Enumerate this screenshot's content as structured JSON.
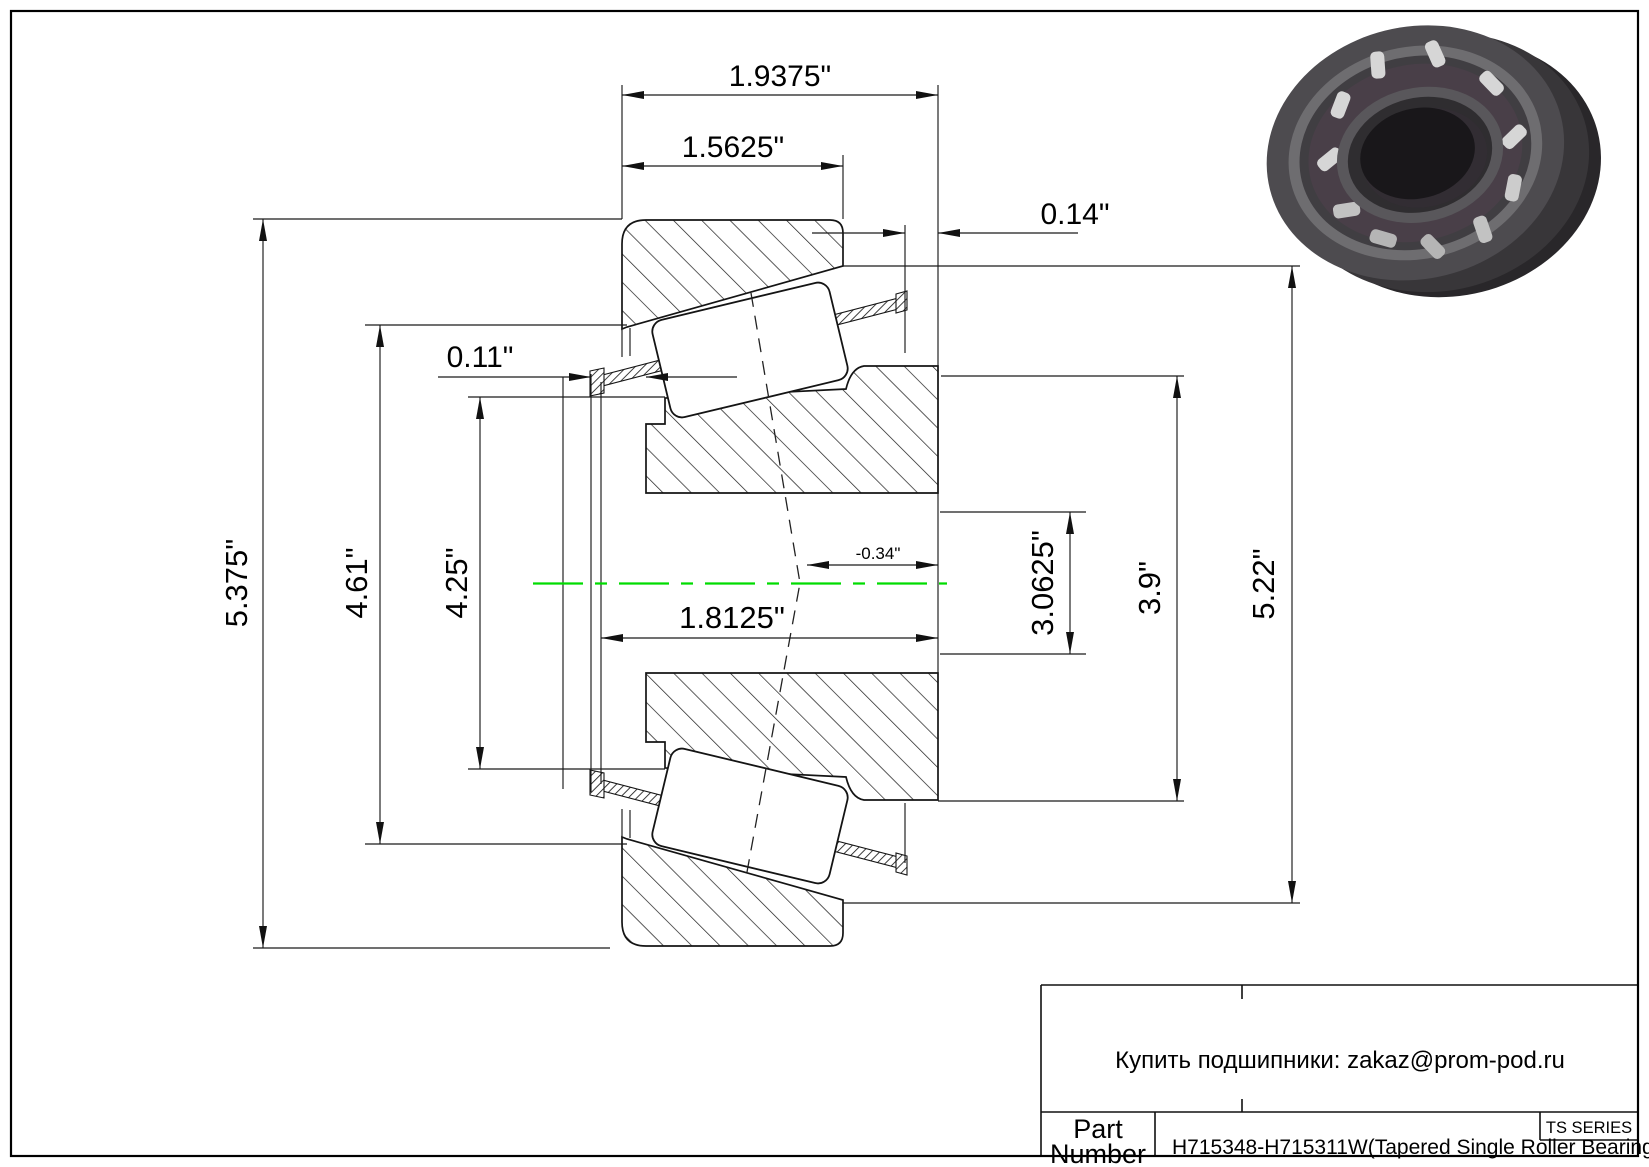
{
  "drawing": {
    "type": "Tapered roller bearing cross-section drawing",
    "dimensions": {
      "overall_width": "1.9375\"",
      "cup_width": "1.5625\"",
      "back_offset": "0.14\"",
      "front_offset": "0.11\"",
      "outer_diameter": "5.375\"",
      "dia_4_61": "4.61\"",
      "dia_4_25": "4.25\"",
      "cone_width": "1.8125\"",
      "center_offset": "-0.34\"",
      "bore_diameter": "3.0625\"",
      "dia_3_9": "3.9\"",
      "dia_5_22": "5.22\""
    },
    "colors": {
      "centerline_green": "#00DC00",
      "line_black": "#141414",
      "background": "#ffffff"
    }
  },
  "title_block": {
    "contact": "Купить подшипники: zakaz@prom-pod.ru",
    "series": "TS SERIES",
    "part_label_line1": "Part",
    "part_label_line2": "Number",
    "part_value": "H715348-H715311W(Tapered Single Roller Bearings)"
  }
}
